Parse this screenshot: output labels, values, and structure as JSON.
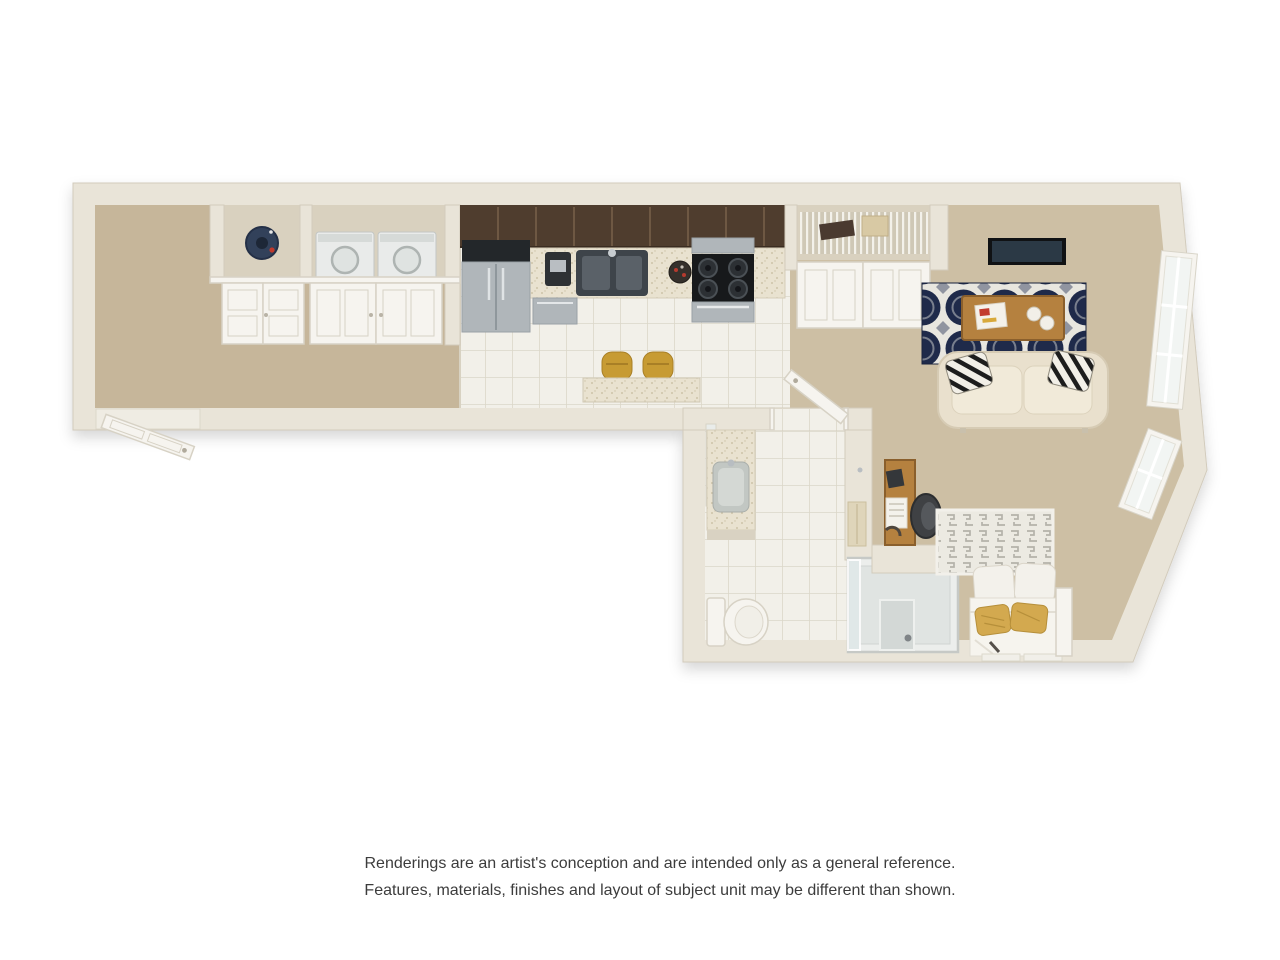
{
  "page": {
    "background": "#ffffff"
  },
  "floor_plan": {
    "type": "3d-floor-plan-rendering",
    "unit_style": "studio-apartment",
    "rooms": [
      {
        "name": "entry-hall",
        "floor": "carpet",
        "features": [
          "entry-door",
          "double-door-closets"
        ]
      },
      {
        "name": "utility-closet",
        "contents": [
          "water-heater"
        ]
      },
      {
        "name": "laundry-closet",
        "contents": [
          "washer",
          "dryer"
        ]
      },
      {
        "name": "kitchen",
        "floor": "tile",
        "features": [
          "refrigerator",
          "coffee-maker",
          "double-sink",
          "dishwasher",
          "gas-range",
          "microwave",
          "upper-cabinets",
          "breakfast-bar",
          "two-bar-stools"
        ]
      },
      {
        "name": "pantry-closet",
        "contents": [
          "wire-shelving",
          "storage-box",
          "hanging-items"
        ]
      },
      {
        "name": "living-room",
        "floor": "carpet",
        "features": [
          "wall-mounted-tv",
          "area-rug",
          "coffee-table",
          "loveseat-sofa",
          "accent-pillows",
          "large-window",
          "small-window"
        ]
      },
      {
        "name": "bathroom",
        "floor": "tile",
        "features": [
          "vanity-sink",
          "mirror",
          "toilet",
          "shower-stall",
          "towel",
          "door"
        ]
      },
      {
        "name": "sleeping-nook",
        "floor": "carpet",
        "features": [
          "desk",
          "office-chair",
          "bed",
          "patterned-headboard",
          "gold-pillows",
          "window"
        ]
      }
    ]
  },
  "disclaimer": {
    "line1": "Renderings are an artist's conception and are intended only as a general reference.",
    "line2": "Features, materials, finishes and layout of subject unit may be different than shown."
  },
  "colors": {
    "wall": "#e9e4d8",
    "wall_edge": "#d2cbbc",
    "carpet": "#c6b69a",
    "carpet_light": "#cdbfa4",
    "closet_floor": "#d9d1bf",
    "tile": "#f2f0e9",
    "tile_line": "#dbd7c9",
    "cabinet_dark": "#4f3d2e",
    "cabinet_line": "#6e5843",
    "counter": "#e9e2d0",
    "steel": "#b0b6ba",
    "steel_dark": "#23272a",
    "black": "#17191b",
    "rug_navy": "#1f2a4a",
    "rug_white": "#e8e6df",
    "rug_grey": "#9094a0",
    "wood": "#b5813f",
    "wood_dark": "#8a5f2c",
    "sofa": "#e9e0cd",
    "sofa_cushion": "#f1ead9",
    "gold": "#c79b33",
    "gold_pillow": "#d3a94f",
    "white_fixture": "#f6f4ef",
    "door_line": "#d7d2c5",
    "glass": "#dfe7e8",
    "heater_navy": "#32415a",
    "chair_dark": "#3f4144",
    "headboard_grey": "#b4b2a9",
    "text": "#3c3c3c"
  }
}
